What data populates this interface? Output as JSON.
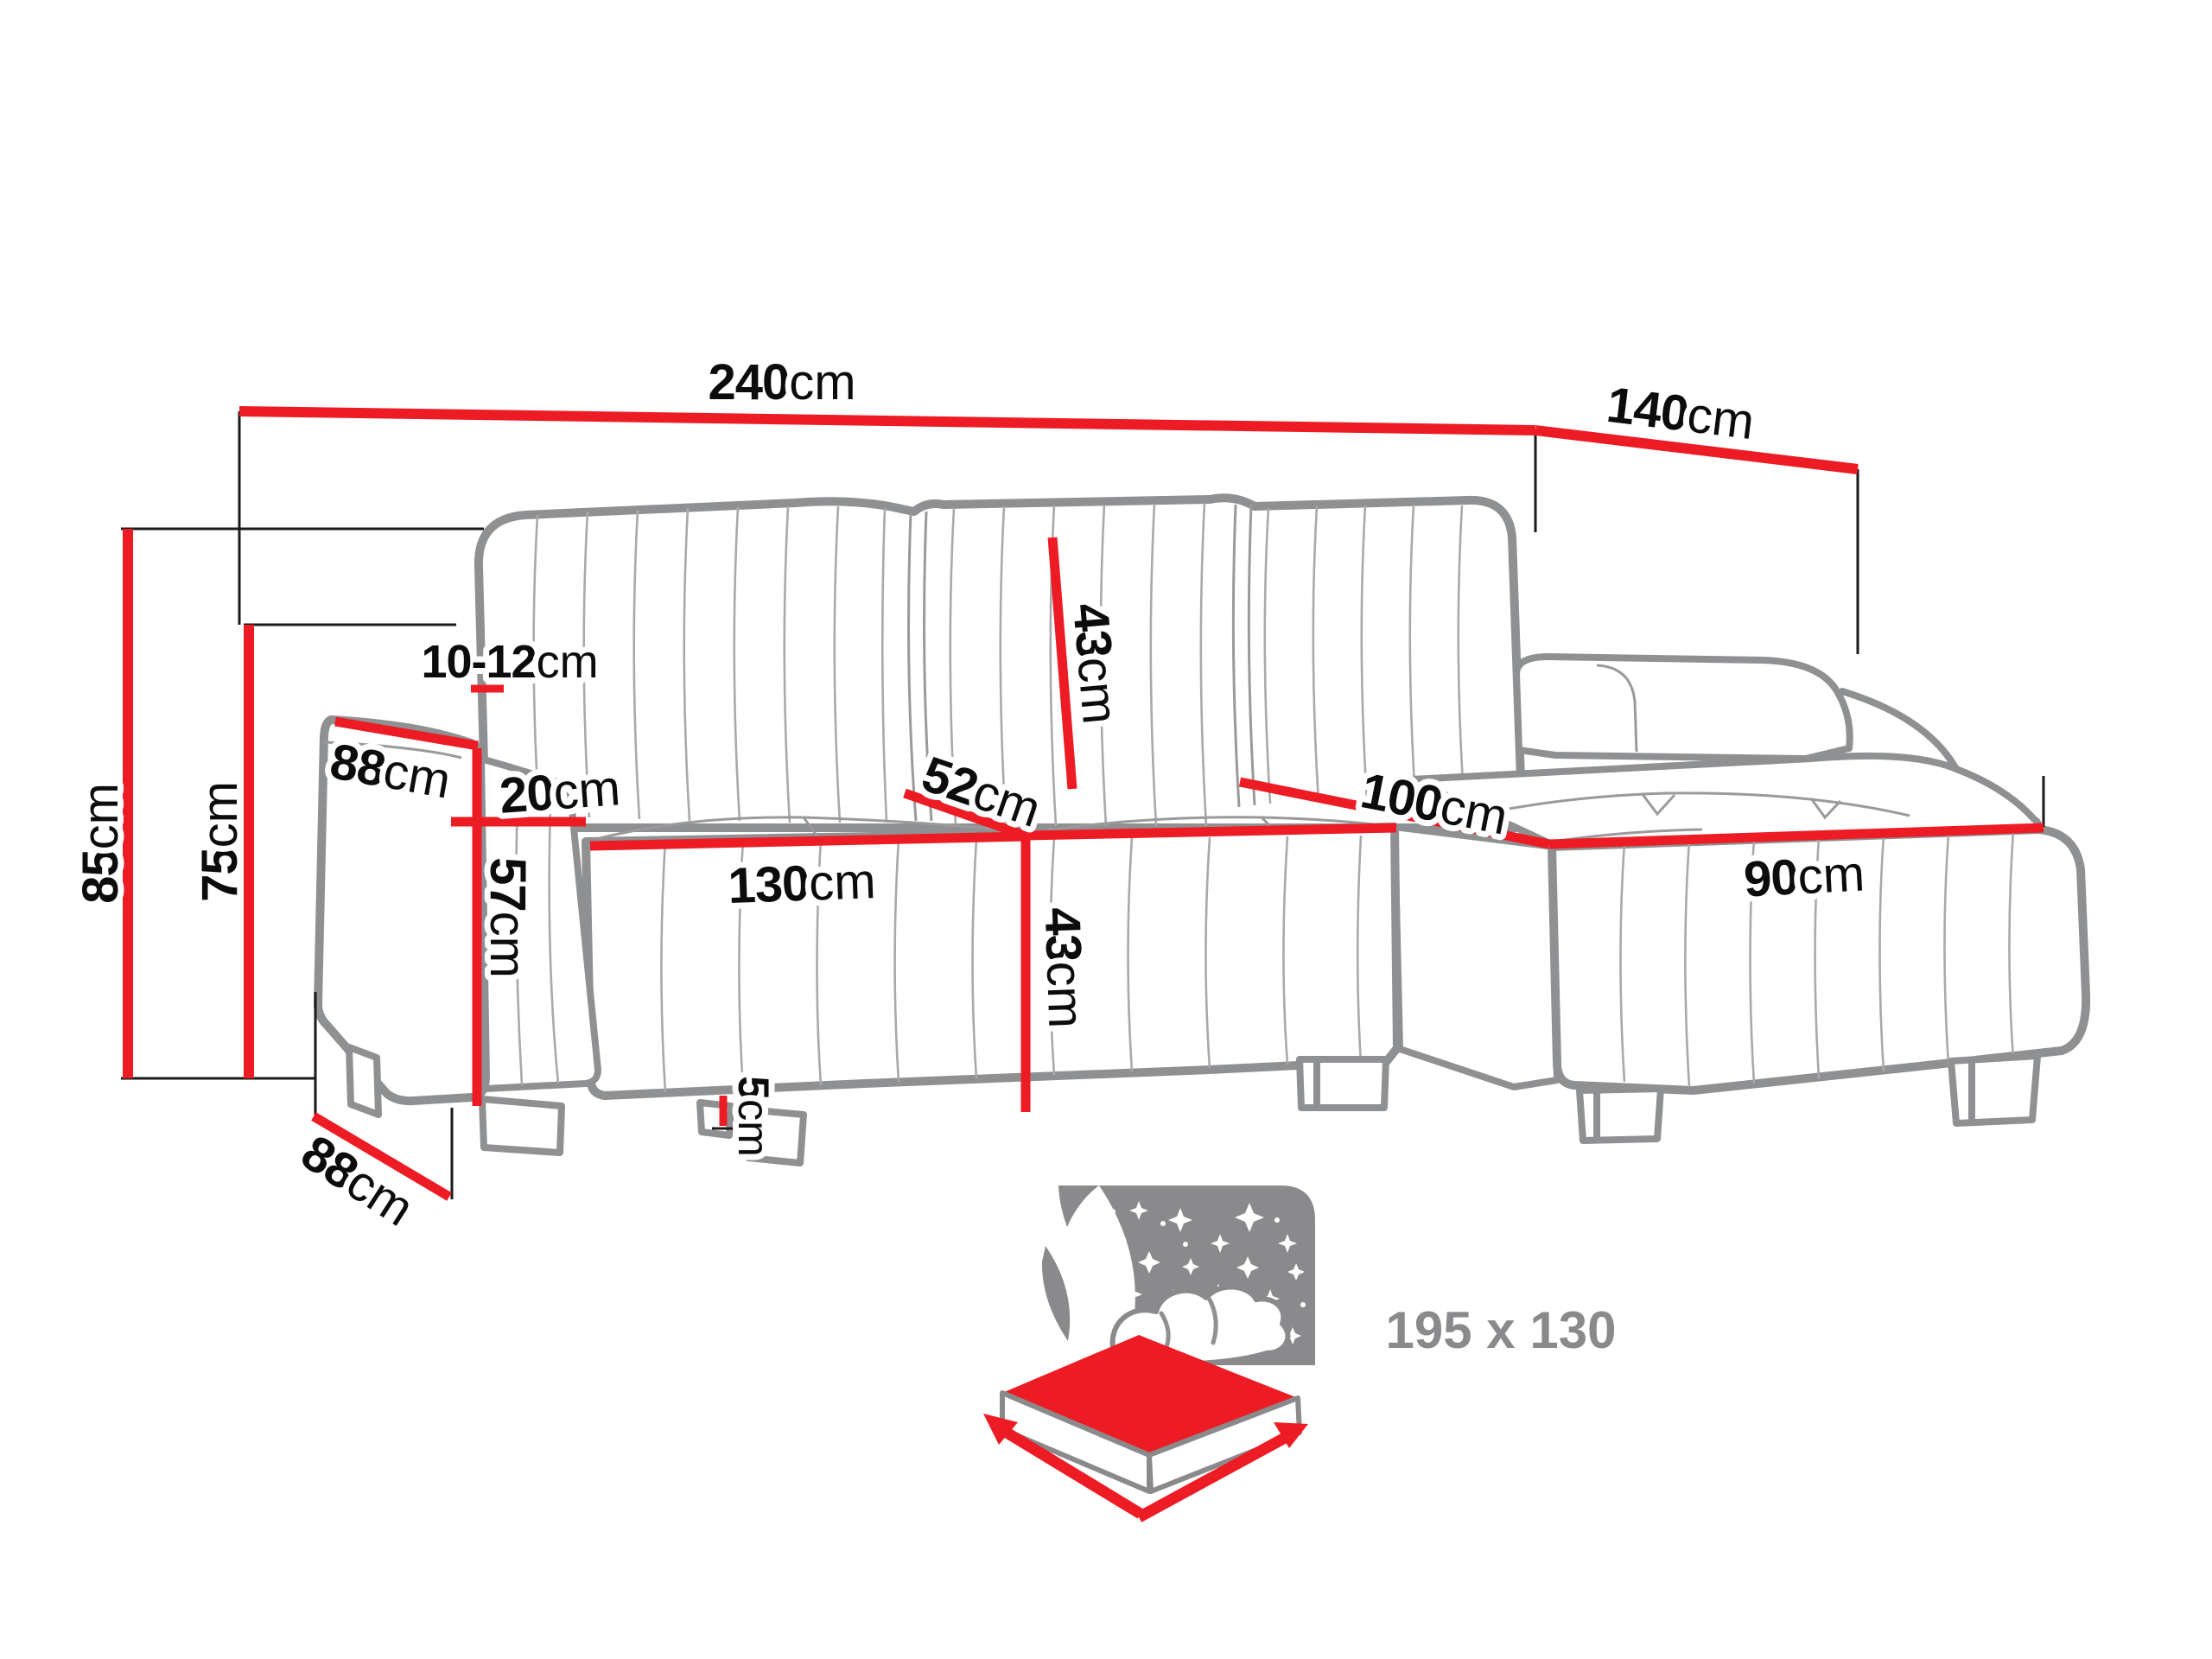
{
  "diagram": {
    "type": "corner-sofa-dimension-diagram",
    "colors": {
      "dimension_red": "#ed1c24",
      "sofa_outline_gray": "#8f9092",
      "label_black": "#0c0c0c",
      "icon_gray": "#8a8a8c"
    },
    "dimensions": {
      "total_width": {
        "value": "240",
        "unit": "cm"
      },
      "total_depth": {
        "value": "140",
        "unit": "cm"
      },
      "total_height": {
        "value": "85",
        "unit": "cm"
      },
      "armrest_height": {
        "value": "75",
        "unit": "cm"
      },
      "back_gap": {
        "value": "10-12",
        "unit": "cm"
      },
      "armrest_depth": {
        "value": "88",
        "unit": "cm"
      },
      "armrest_width": {
        "value": "20",
        "unit": "cm"
      },
      "armrest_front_height": {
        "value": "57",
        "unit": "cm"
      },
      "seat_depth": {
        "value": "52",
        "unit": "cm"
      },
      "backrest_height": {
        "value": "43",
        "unit": "cm"
      },
      "seat_width": {
        "value": "130",
        "unit": "cm"
      },
      "seat_front_height": {
        "value": "43",
        "unit": "cm"
      },
      "chaise_length": {
        "value": "100",
        "unit": "cm"
      },
      "chaise_width": {
        "value": "90",
        "unit": "cm"
      },
      "leg_height": {
        "value": "5",
        "unit": "cm"
      },
      "base_depth": {
        "value": "88",
        "unit": "cm"
      }
    },
    "sleeping_function": {
      "size_label": "195 x 130"
    }
  }
}
